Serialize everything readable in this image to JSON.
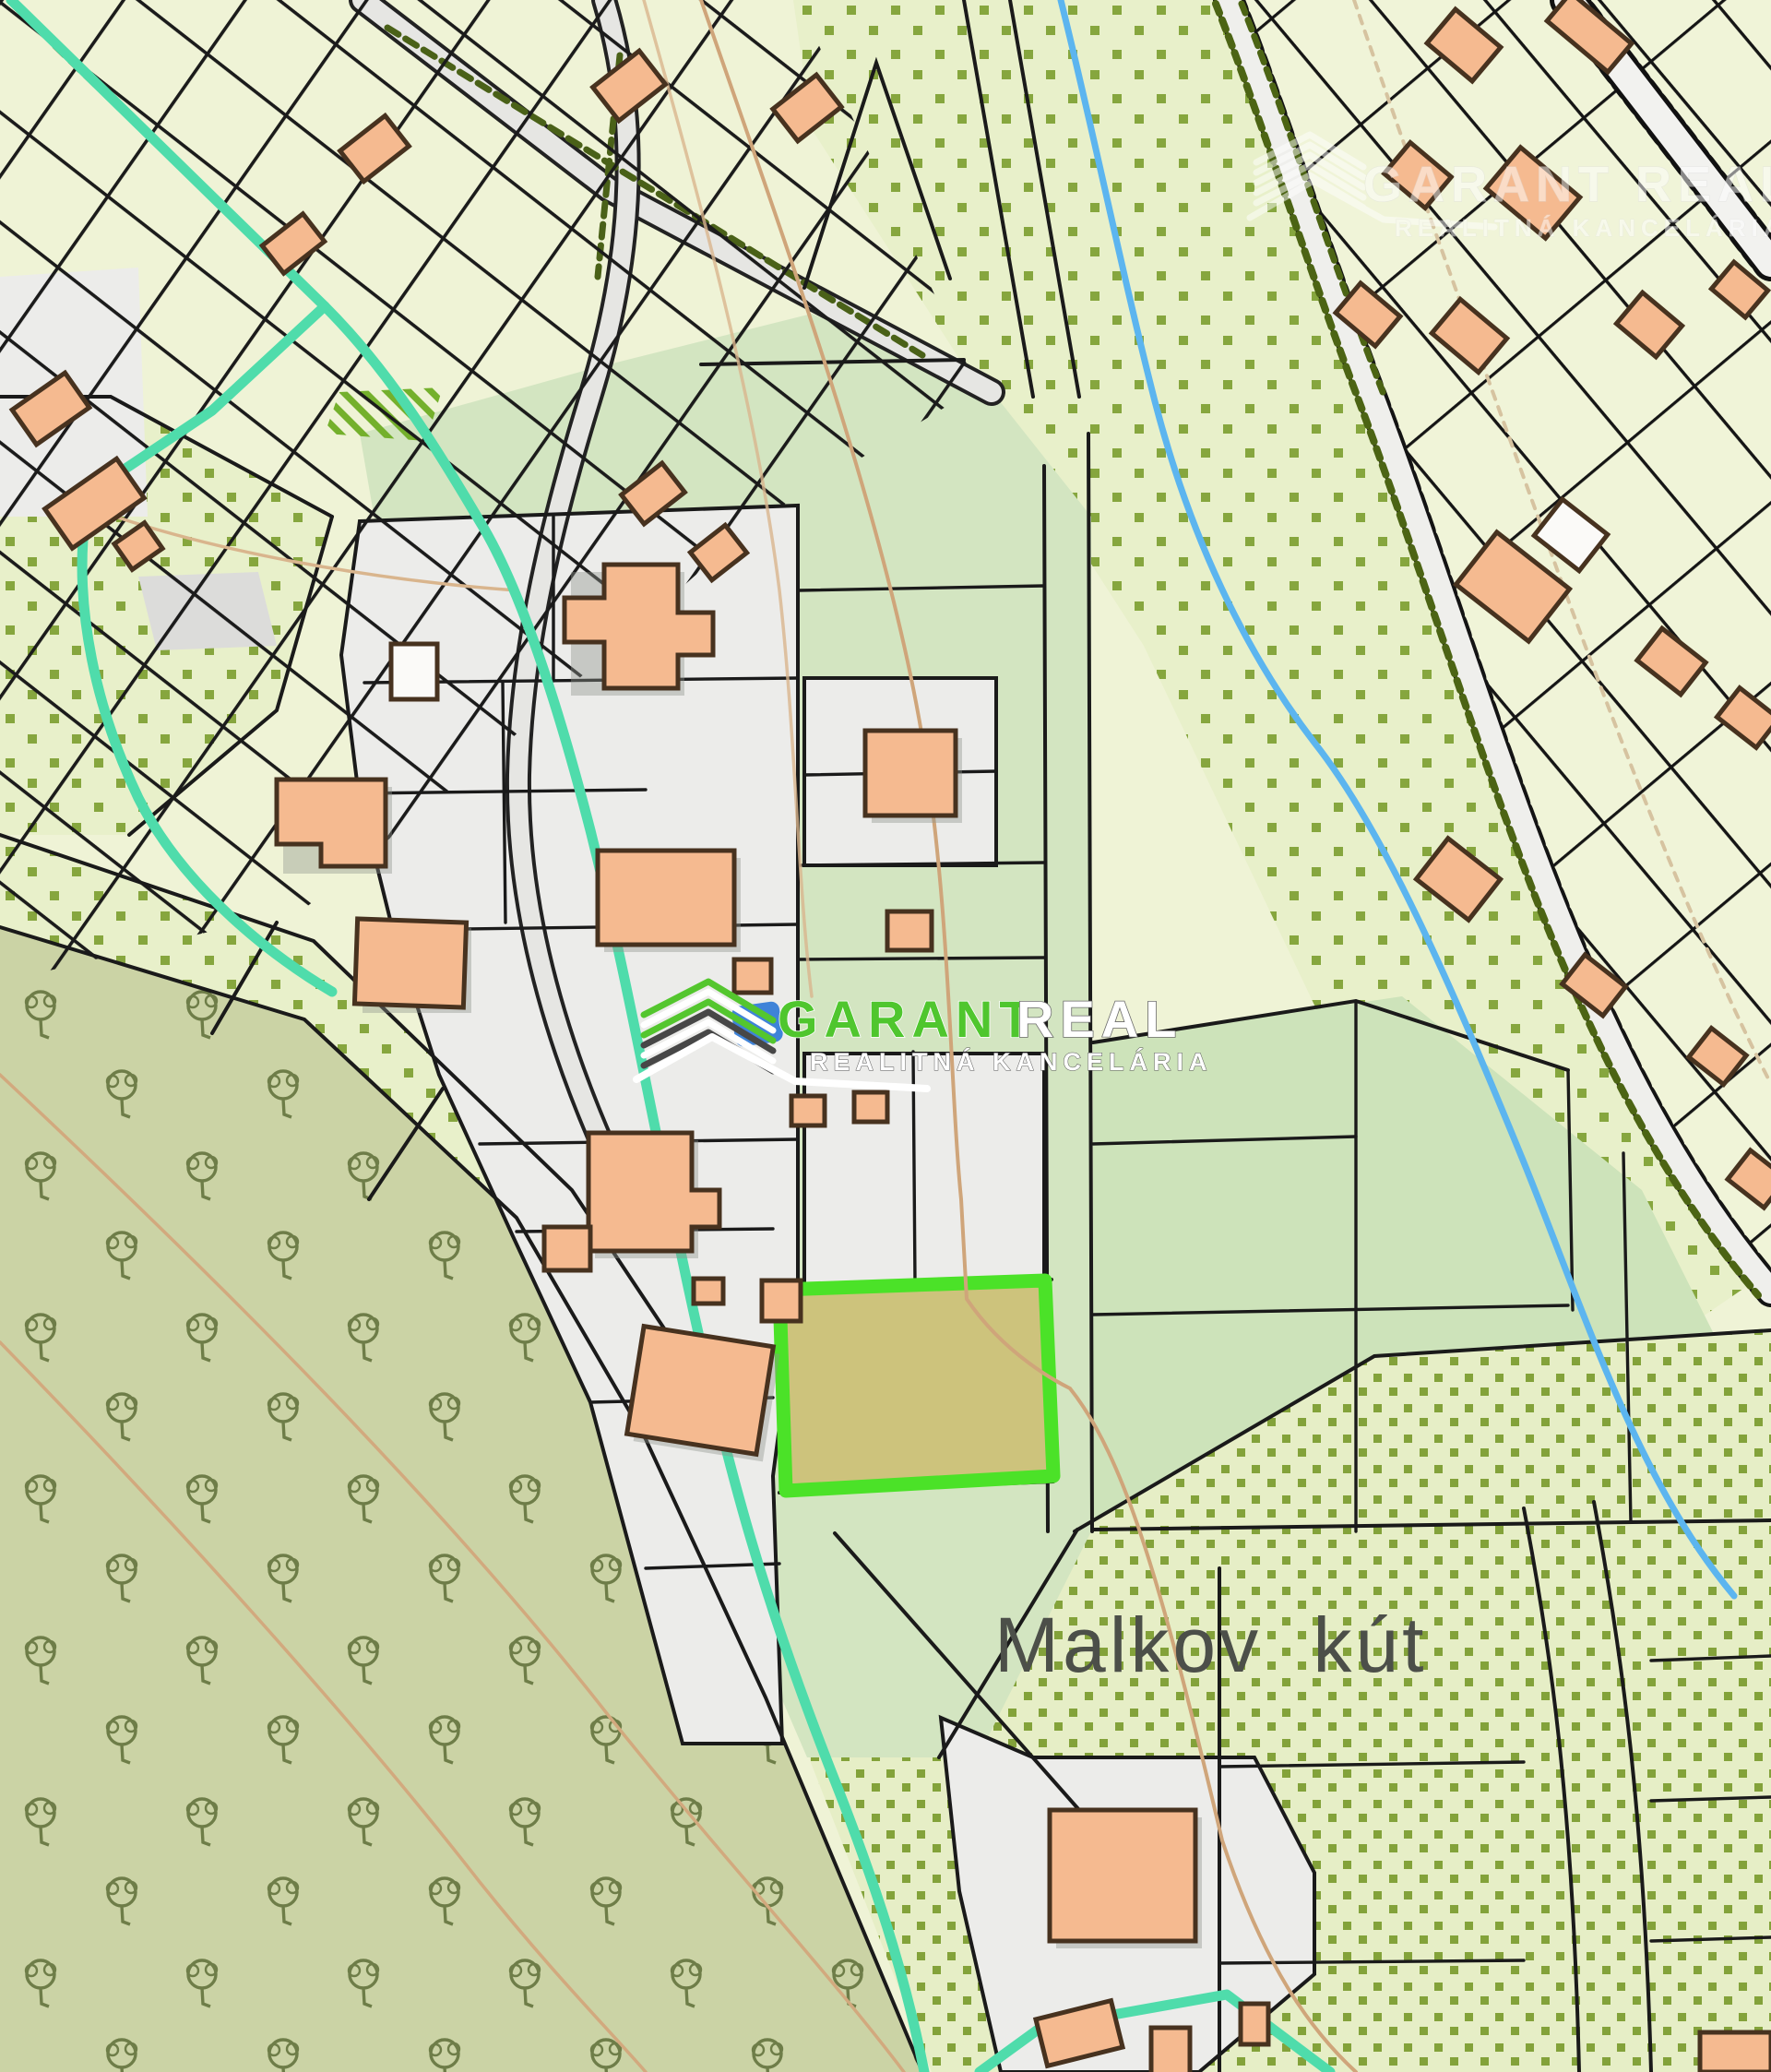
{
  "map": {
    "place_label": "Malkov kút",
    "watermark": {
      "brand": "GARANT REAL",
      "brand_primary": "GARANT",
      "brand_secondary": "REAL",
      "subtitle": "REALITNÁ KANCELÁRIA"
    },
    "colors": {
      "highlight_stroke": "#4be228",
      "highlight_fill": "#cdc37c",
      "brand_green": "#4fc62e",
      "watermark_white": "#ffffff",
      "teal_boundary": "#4fdcab",
      "stream_blue": "#5cb5ef",
      "building_fill": "#f5ba90",
      "building_outline": "#47321f",
      "contour_tan": "#d9b58d",
      "parcel_line": "#1a1a1a",
      "meadow_dot": "#86a63e",
      "cream_parcel": "#eff3d6",
      "green_parcel": "#cde3ba",
      "orchard_fill": "#cbd3a5",
      "residential_fill": "#ececea",
      "place_label_color": "#4c4f49"
    }
  }
}
